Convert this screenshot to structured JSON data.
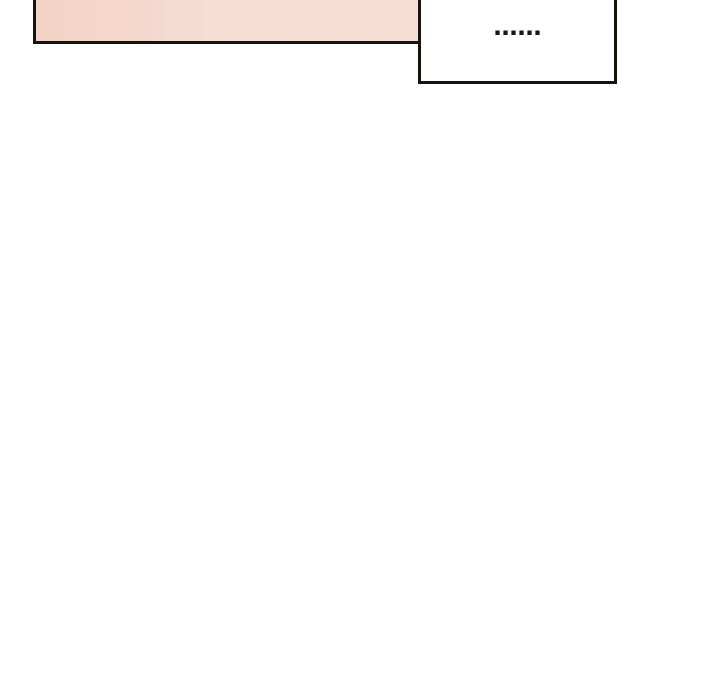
{
  "colors": {
    "page_bg": "#ffffff",
    "line": "#17120e",
    "panel_fill_left": "#f2d2c5",
    "panel_fill_mid": "#f6dcd1",
    "panel_fill_right": "#f7ded4",
    "bubble_fill": "#ffffff",
    "bubble_text": "#161616"
  },
  "comic": {
    "speech_bubble": {
      "text": "……"
    }
  }
}
